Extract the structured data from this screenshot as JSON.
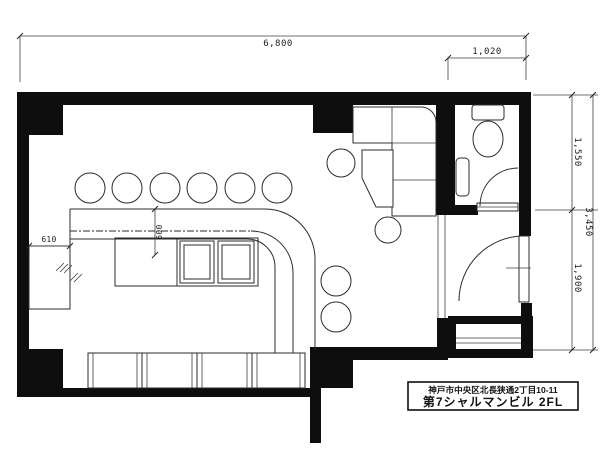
{
  "title_block": {
    "address": "神戸市中央区北長狭通2丁目10-11",
    "building": "第7シャルマンビル 2FL"
  },
  "dimensions": {
    "top_width": "6,800",
    "toilet_width": "1,020",
    "right_upper": "1,550",
    "right_lower": "1,900",
    "right_total": "3,450",
    "left_cabinet": "610",
    "counter_depth": "600"
  },
  "colors": {
    "wall": "#0e0e0e",
    "furniture_line": "#2b2b2b",
    "dimension_line": "#3f3f3f",
    "background": "#ffffff"
  }
}
